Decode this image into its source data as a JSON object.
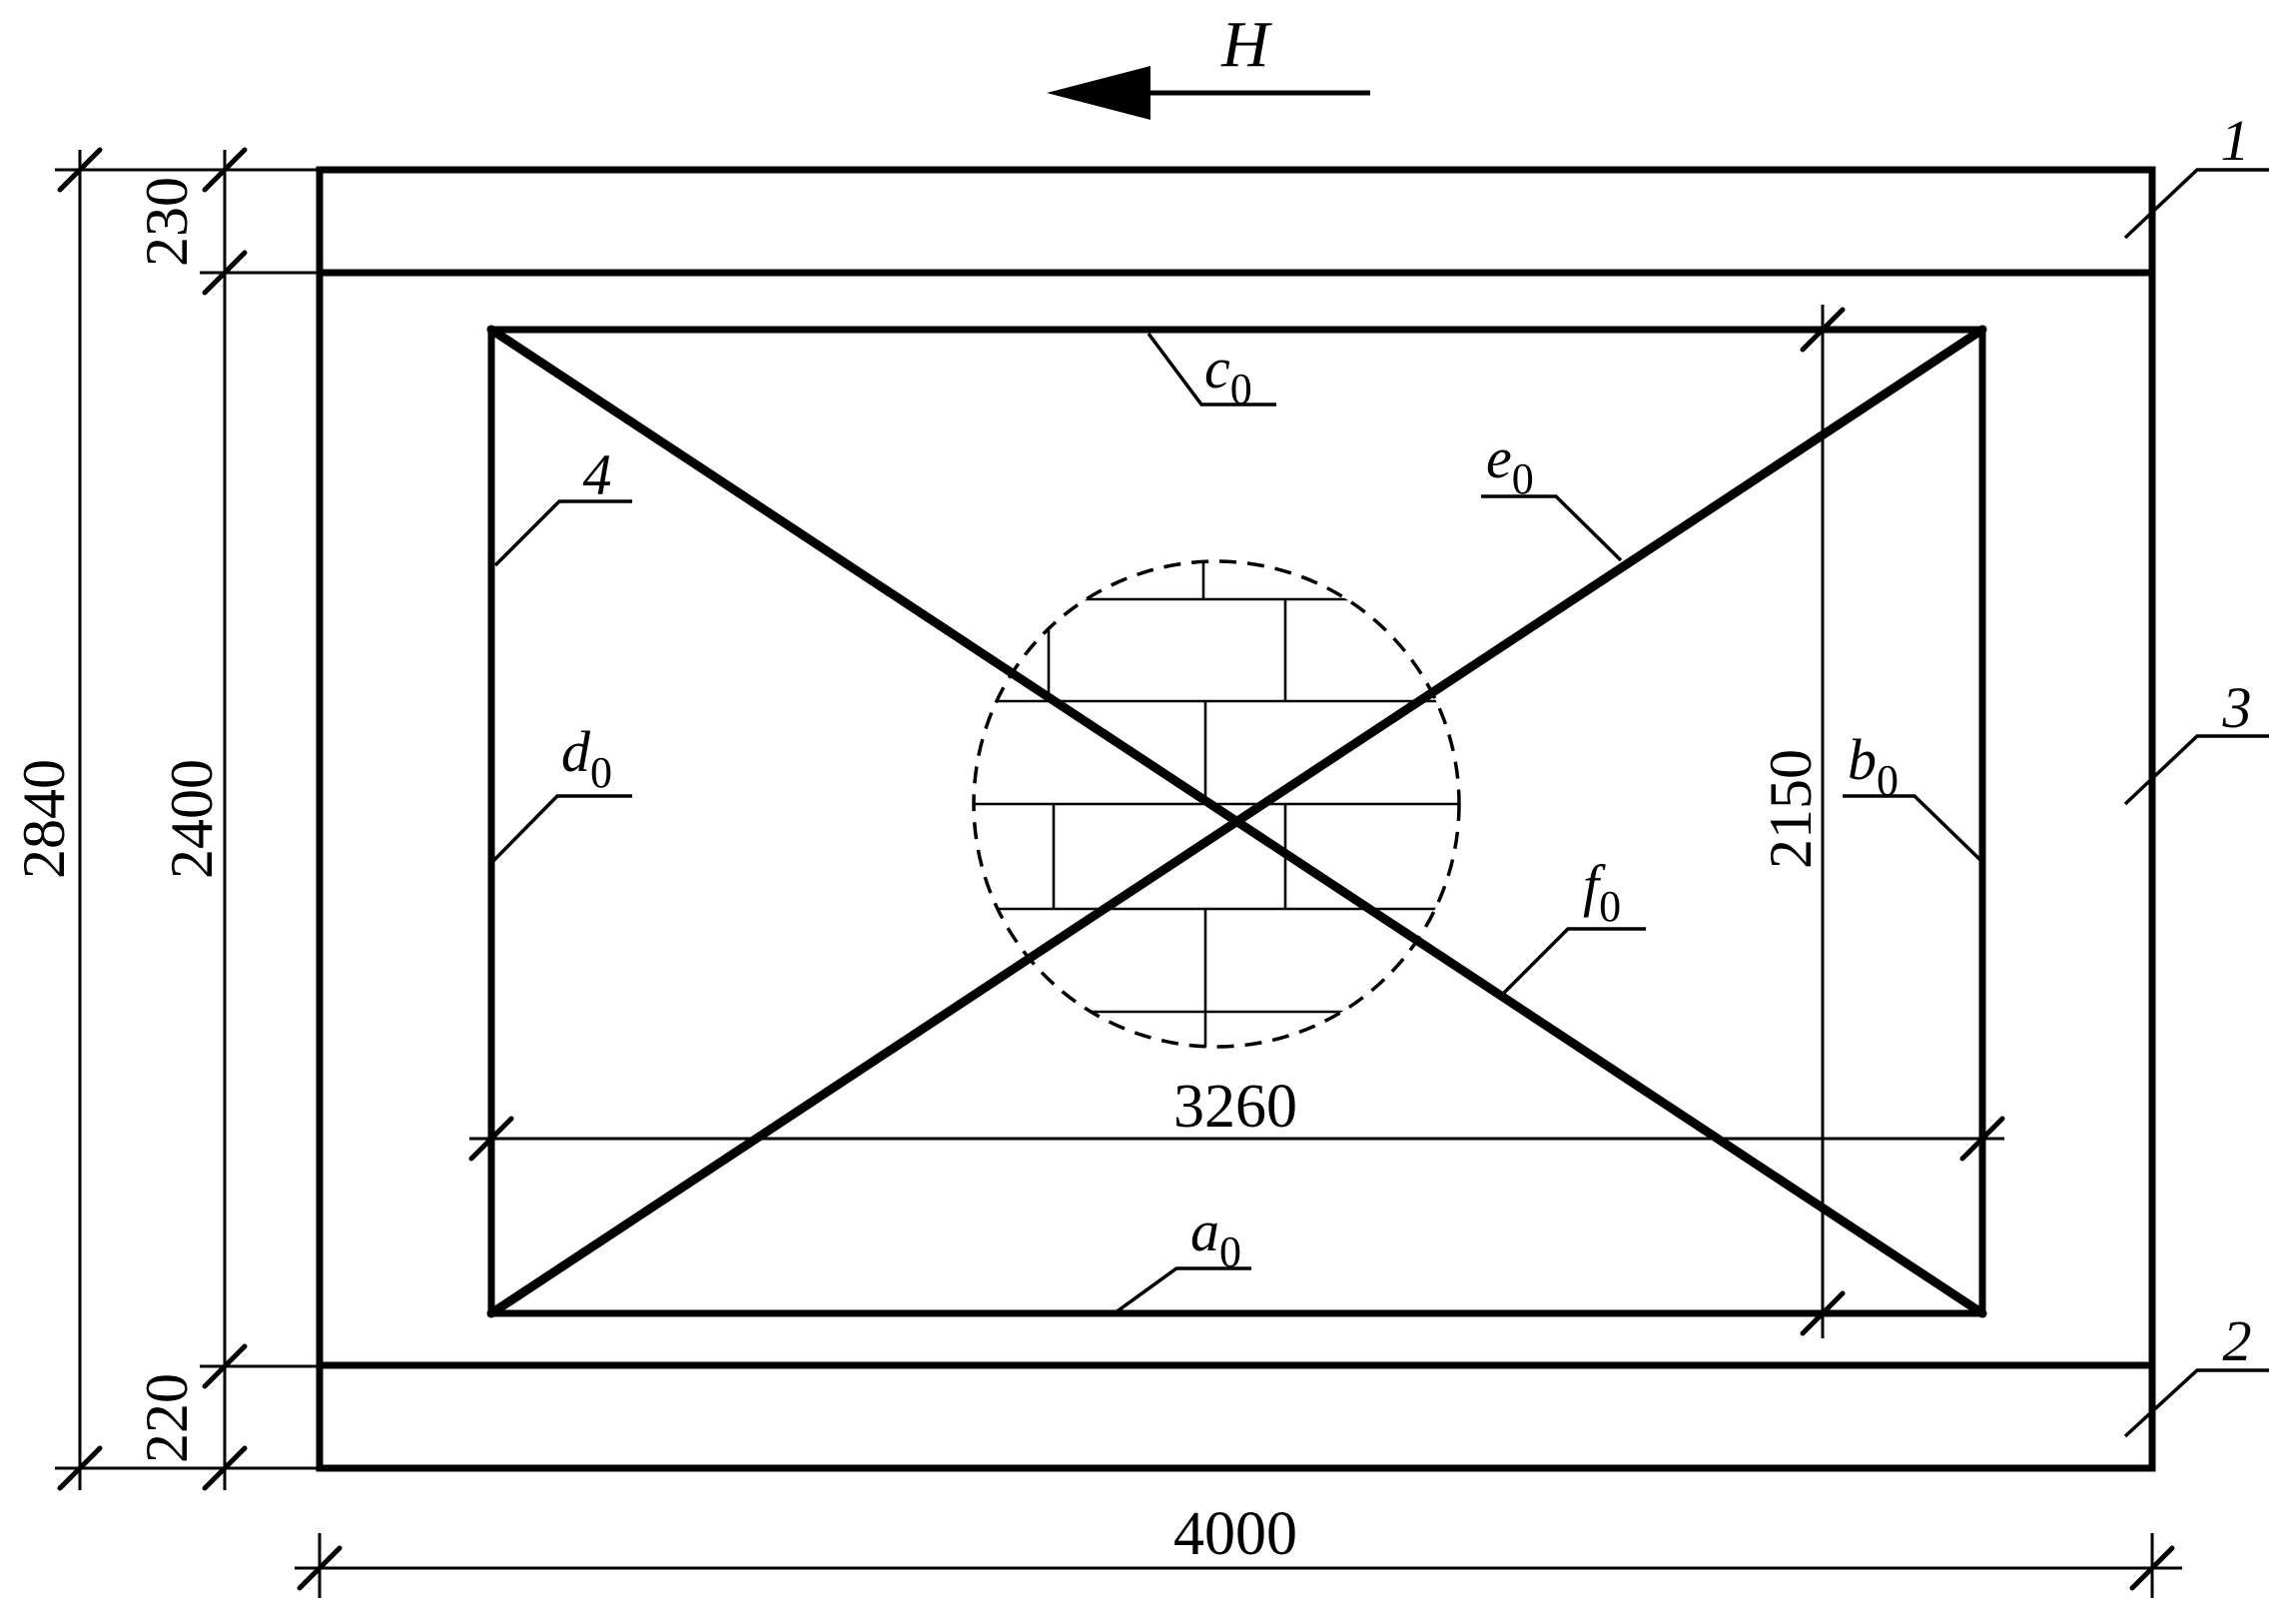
{
  "drawing": {
    "load_label": "H",
    "parts": {
      "top_beam": "1",
      "bottom_beam": "2",
      "panel": "3",
      "frame": "4"
    },
    "gauges": {
      "a": {
        "base": "a",
        "sub": "0"
      },
      "b": {
        "base": "b",
        "sub": "0"
      },
      "c": {
        "base": "c",
        "sub": "0"
      },
      "d": {
        "base": "d",
        "sub": "0"
      },
      "e": {
        "base": "e",
        "sub": "0"
      },
      "f": {
        "base": "f",
        "sub": "0"
      }
    },
    "dimensions": {
      "overall_height": "2840",
      "clear_height": "2400",
      "top_beam_depth": "230",
      "bottom_beam_depth": "220",
      "overall_width": "4000",
      "frame_width": "3260",
      "frame_height": "2150"
    },
    "colors": {
      "beam_fill": "#7d7d7d",
      "panel_fill": "#dcdcdc",
      "line": "#000000",
      "background": "#ffffff"
    }
  }
}
